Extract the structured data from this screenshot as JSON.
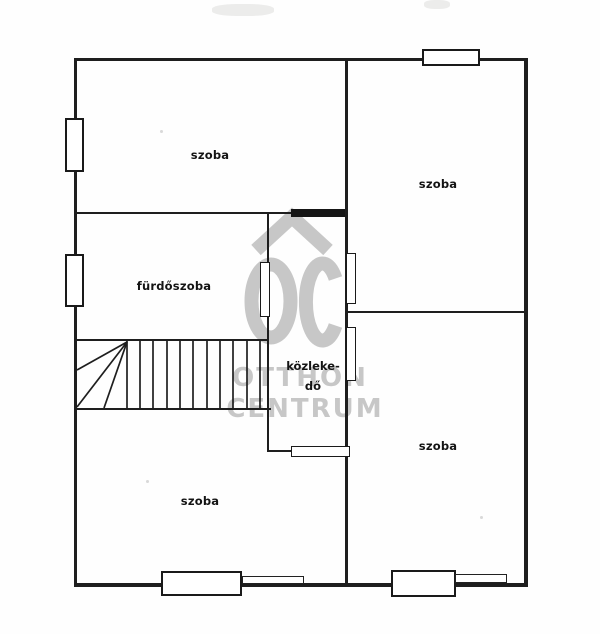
{
  "plan": {
    "rooms": {
      "top_left": {
        "label": "szoba"
      },
      "top_right": {
        "label": "szoba"
      },
      "bathroom": {
        "label": "fürdőszoba"
      },
      "corridor": {
        "label_line1": "közleke-",
        "label_line2": "dő"
      },
      "bottom_left": {
        "label": "szoba"
      },
      "bottom_right": {
        "label": "szoba"
      }
    }
  },
  "watermark": {
    "logo_text": "OC",
    "name_line1": "OTTHON",
    "name_line2": "CENTRUM",
    "color": "#c3c3c3"
  },
  "colors": {
    "wall": "#1e1e1e",
    "paper": "#fefefe",
    "label_text": "#141414"
  }
}
